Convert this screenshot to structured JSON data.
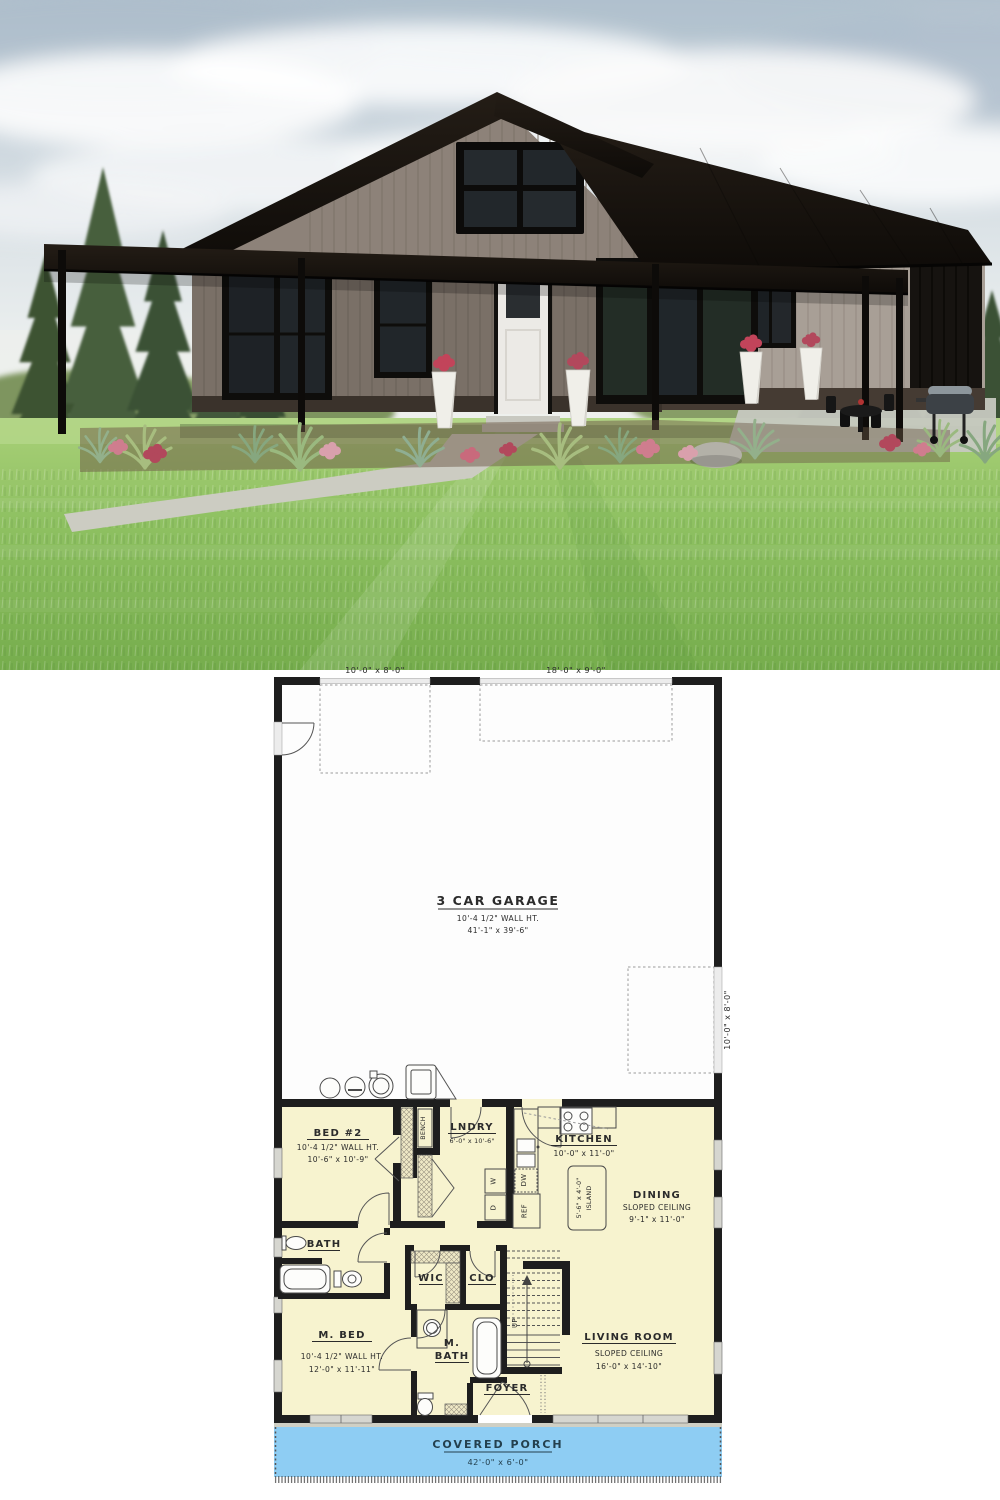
{
  "palette": {
    "porch_fill": "#8ecdf3",
    "floor_fill": "#f7f3cf",
    "wall_color": "#1e1e1e",
    "roof_color": "#171310",
    "siding_upper": "#8d8279",
    "siding_lower": "#a89f96",
    "wainscot": "#453b33",
    "grass": "#8fc162"
  },
  "plan": {
    "top_door_small": "10'-0\" x 8'-0\"",
    "top_door_large": "18'-0\" x 9'-0\"",
    "side_door": "10'-0\" x 8'-0\"",
    "garage": {
      "name": "3 CAR GARAGE",
      "wall_ht": "10'-4 1/2\" WALL HT.",
      "dims": "41'-1\" x 39'-6\""
    },
    "bed2": {
      "name": "BED #2",
      "wall_ht": "10'-4 1/2\" WALL HT.",
      "dims": "10'-6\" x 10'-9\""
    },
    "laundry": {
      "name": "LNDRY",
      "dims": "6'-0\" x 10'-6\""
    },
    "kitchen": {
      "name": "KITCHEN",
      "dims": "10'-0\" x 11'-0\""
    },
    "dining": {
      "name": "DINING",
      "ceiling": "SLOPED CEILING",
      "dims": "9'-1\" x 11'-0\""
    },
    "island": {
      "dims": "5'-6\" x 4'-0\"",
      "name": "ISLAND"
    },
    "bath": {
      "name": "BATH"
    },
    "wic": {
      "name": "WIC"
    },
    "closet": {
      "name": "CLO"
    },
    "master_bed": {
      "name": "M. BED",
      "wall_ht": "10'-4 1/2\" WALL HT.",
      "dims": "12'-0\" x 11'-11\""
    },
    "master_bath": {
      "line1": "M.",
      "line2": "BATH"
    },
    "foyer": {
      "name": "FOYER"
    },
    "living": {
      "name": "LIVING ROOM",
      "ceiling": "SLOPED CEILING",
      "dims": "16'-0\" x 14'-10\""
    },
    "porch": {
      "name": "COVERED PORCH",
      "dims": "42'-0\" x 6'-0\""
    },
    "fixtures": {
      "bench": "BENCH",
      "washer": "W",
      "dryer": "D",
      "dishwasher": "DW",
      "fridge": "REF",
      "up": "UP"
    }
  }
}
